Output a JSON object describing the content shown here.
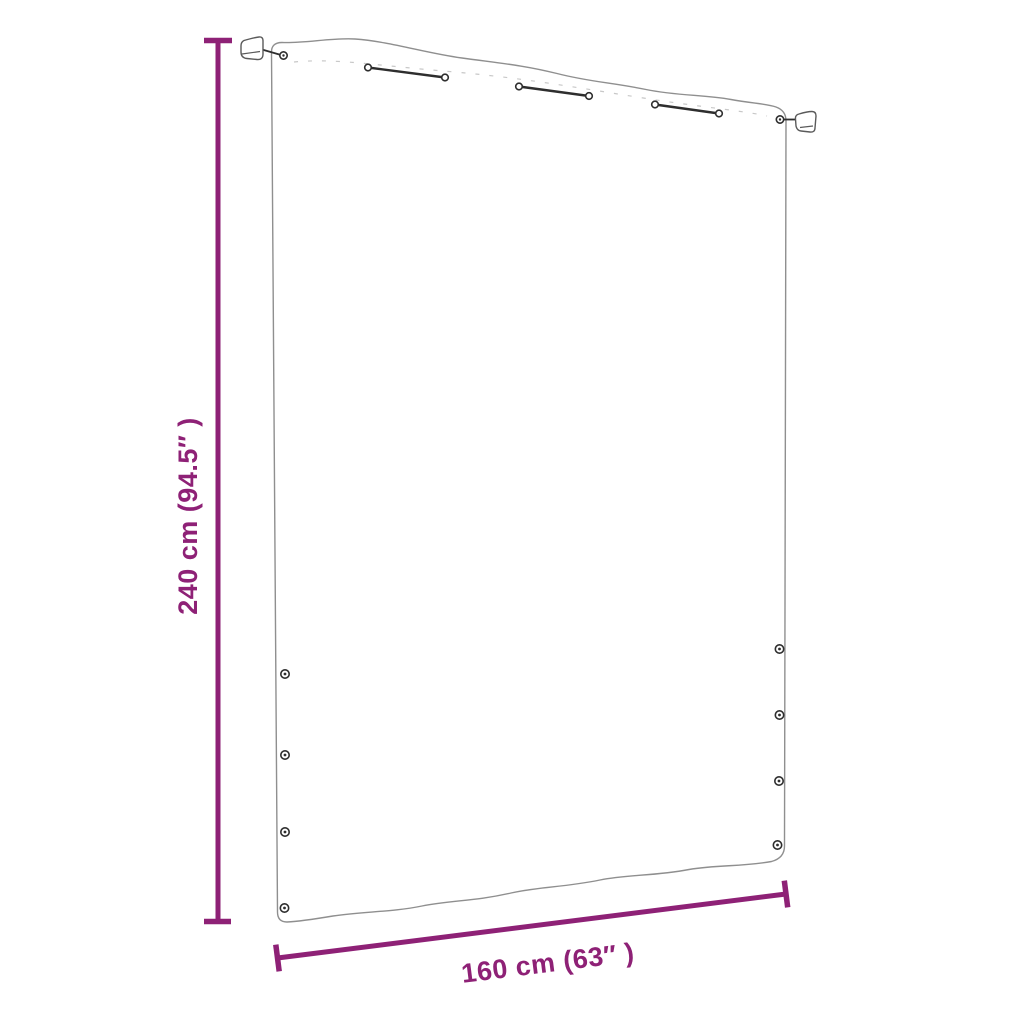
{
  "labels": {
    "height": "240 cm (94.5″ )",
    "width": "160 cm (63″ )"
  },
  "colors": {
    "dimension_accent": "#8E2176",
    "outline_gray": "#8F8F8F",
    "hardware_dark": "#2E2E2E",
    "bracket_gray": "#5A5A5A",
    "stitch_gray": "#C8C8C8"
  }
}
